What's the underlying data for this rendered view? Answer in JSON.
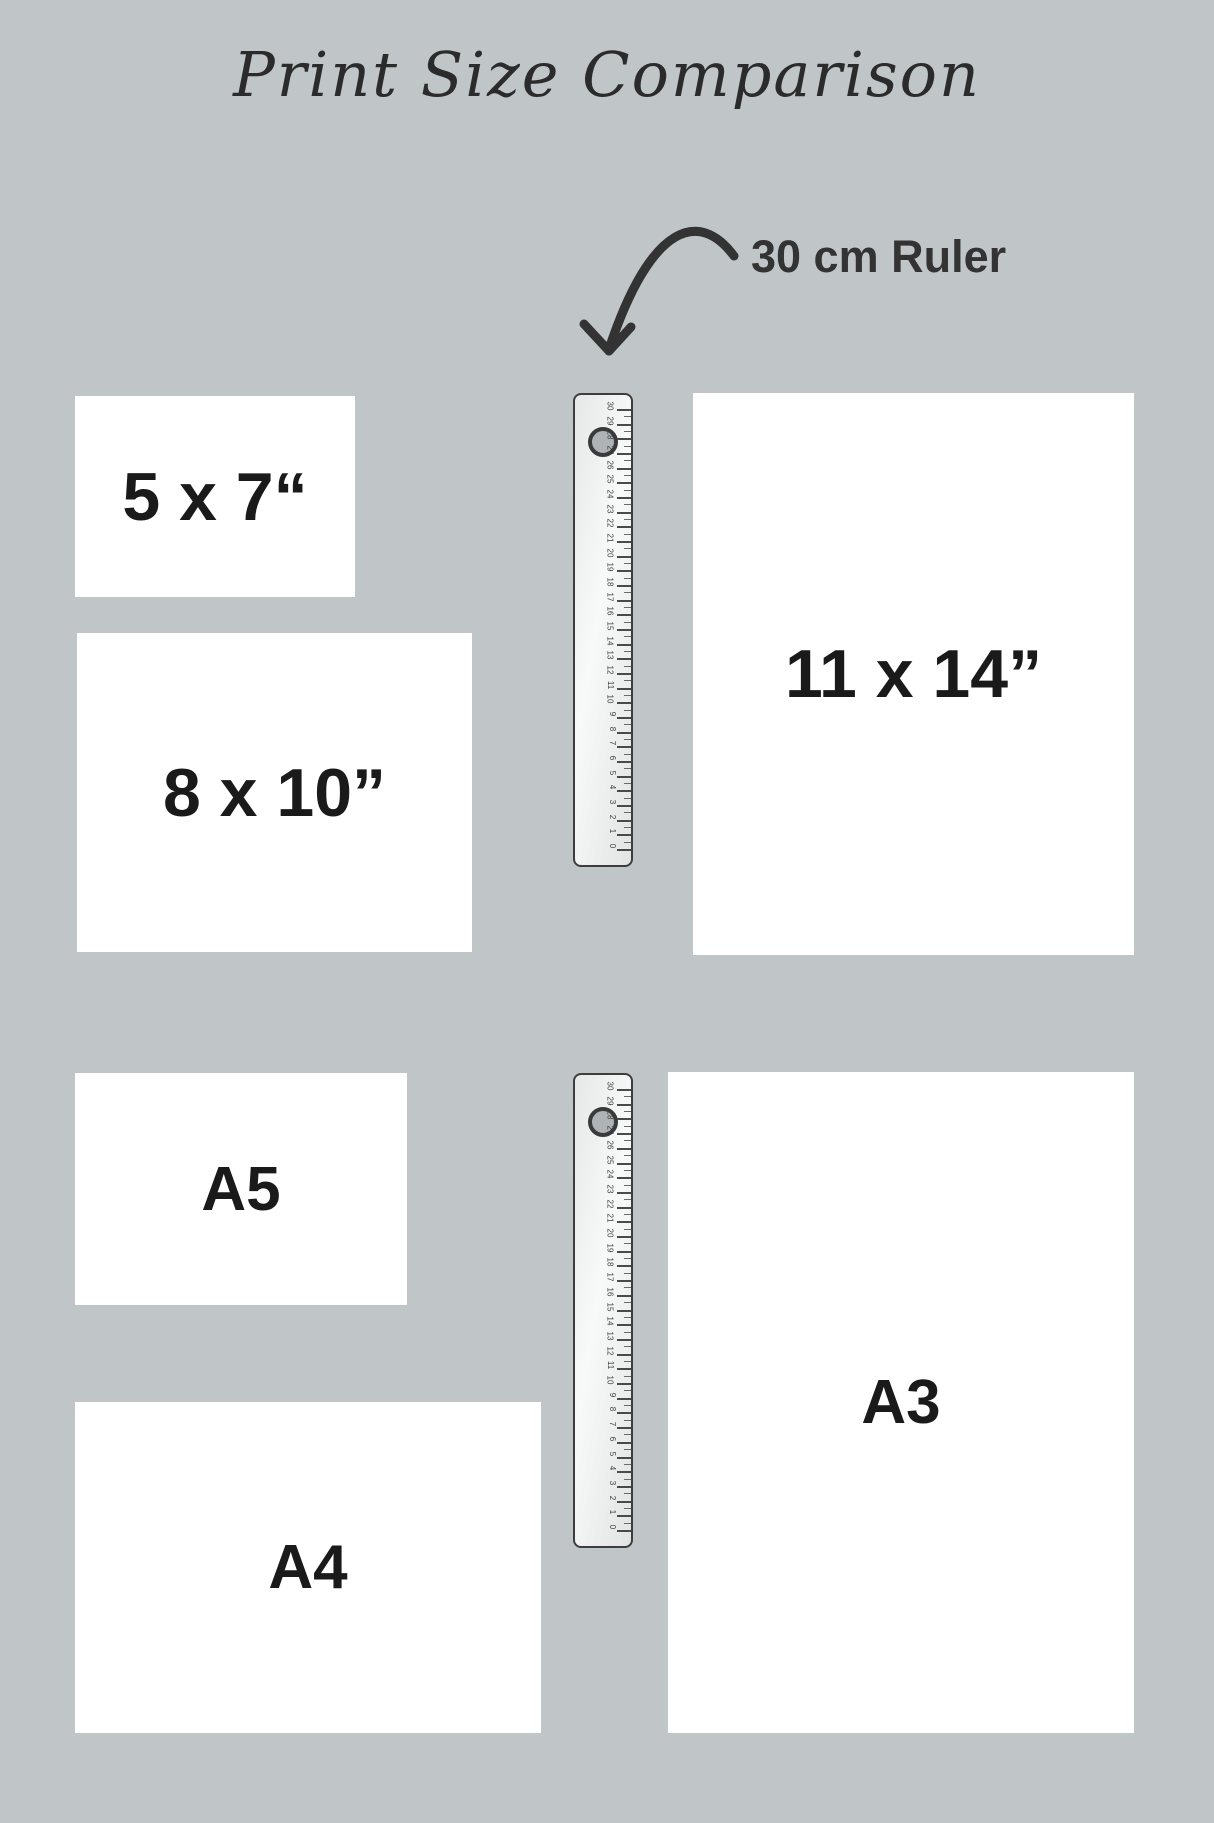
{
  "title": "Print Size Comparison",
  "annotation": {
    "label": "30 cm Ruler"
  },
  "papers": [
    {
      "name": "5x7",
      "label": "5 x 7“"
    },
    {
      "name": "8x10",
      "label": "8 x 10”"
    },
    {
      "name": "11x14",
      "label": "11 x 14”"
    },
    {
      "name": "a5",
      "label": "A5"
    },
    {
      "name": "a4",
      "label": "A4"
    },
    {
      "name": "a3",
      "label": "A3"
    }
  ],
  "ruler": {
    "unit_numbers": [
      "0",
      "1",
      "2",
      "3",
      "4",
      "5",
      "6",
      "7",
      "8",
      "9",
      "10",
      "11",
      "12",
      "13",
      "14",
      "15",
      "16",
      "17",
      "18",
      "19",
      "20",
      "21",
      "22",
      "23",
      "24",
      "25",
      "26",
      "27",
      "28",
      "29",
      "30"
    ]
  },
  "colors": {
    "background": "#c0c6c8",
    "paper": "#ffffff",
    "label_text": "#1a1a1a",
    "annotation_text": "#333333",
    "ruler_border": "#3d3d3d"
  }
}
